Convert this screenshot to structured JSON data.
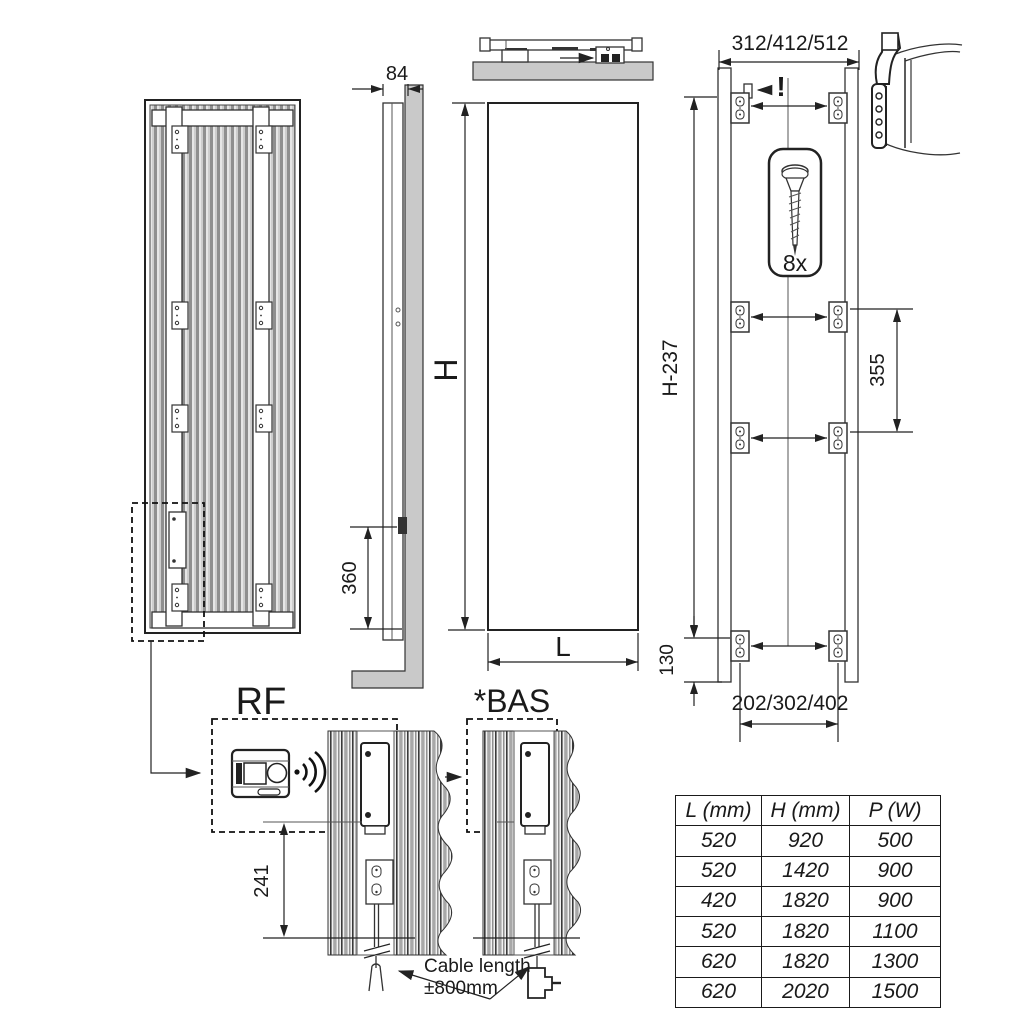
{
  "labels": {
    "depth": "84",
    "height_h": "H",
    "width_l": "L",
    "top_span": "312/412/512",
    "warning": "!",
    "screw_count": "8x",
    "wall_height": "H-237",
    "bracket_vertical_spacing": "355",
    "bottom_offset": "130",
    "bracket_span": "202/302/402",
    "outlet_height": "360",
    "rf": "RF",
    "bas": "*BAS",
    "cable_outlet_height": "241",
    "cable_note_1": "Cable length",
    "cable_note_2": "±800mm"
  },
  "table": {
    "headers": [
      "L (mm)",
      "H (mm)",
      "P (W)"
    ],
    "rows": [
      [
        "520",
        "920",
        "500"
      ],
      [
        "520",
        "1420",
        "900"
      ],
      [
        "420",
        "1820",
        "900"
      ],
      [
        "520",
        "1820",
        "1100"
      ],
      [
        "620",
        "1820",
        "1300"
      ],
      [
        "620",
        "2020",
        "1500"
      ]
    ]
  },
  "colors": {
    "line": "#222222",
    "wall_gray": "#c9c9c9",
    "background": "#ffffff"
  }
}
